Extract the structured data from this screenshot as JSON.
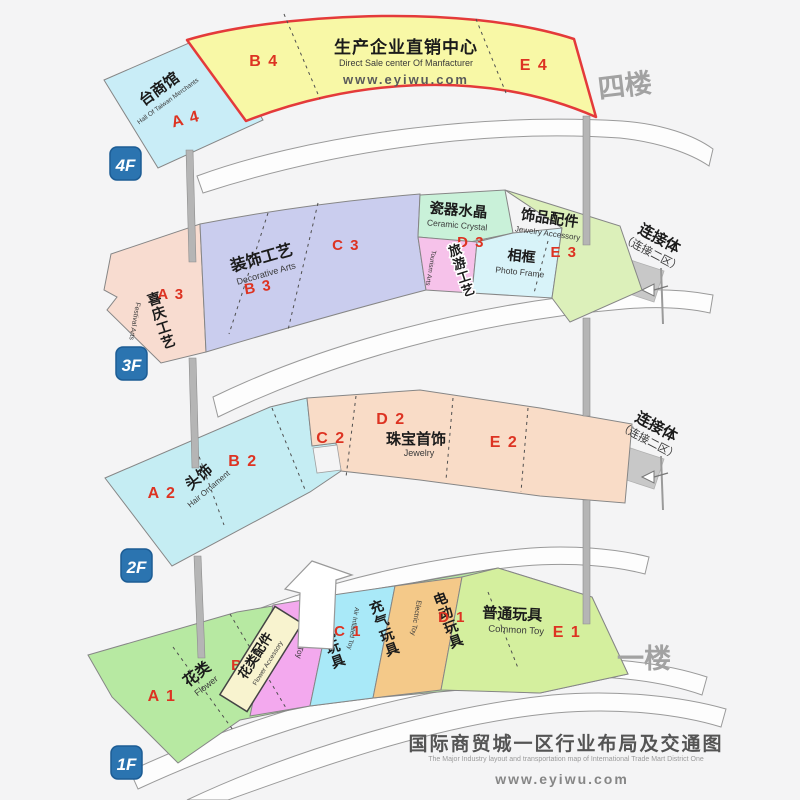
{
  "floor4": {
    "badge": "4F",
    "side_label": "四楼",
    "taiwan_hall": {
      "name": "台商馆",
      "name_en": "Hall Of Taiwan Merchants",
      "code": "A 4"
    },
    "b_code": "B 4",
    "direct_sale": {
      "name": "生产企业直销中心",
      "name_en": "Direct Sale center Of Manfacturer",
      "website": "www.eyiwu.com"
    },
    "e_code": "E 4"
  },
  "floor3": {
    "badge": "3F",
    "festival": {
      "name": "喜庆工艺",
      "name_en": "Festival Arts",
      "code": "A 3"
    },
    "decorative": {
      "name": "装饰工艺",
      "name_en": "Decorative Arts",
      "code_b": "B 3",
      "code_c": "C 3"
    },
    "ceramic": {
      "name": "瓷器水晶",
      "name_en": "Ceramic Crystal",
      "code": "D 3"
    },
    "tourism": {
      "name": "旅游工艺",
      "name_en": "Tourism Arts"
    },
    "photo_frame": {
      "name": "相框",
      "name_en": "Photo Frame"
    },
    "jewelry_accessory": {
      "name": "饰品配件",
      "name_en": "Jewelry Accessory",
      "code": "E 3"
    },
    "connector": {
      "line1": "连接体",
      "line2": "（连接二区）"
    }
  },
  "floor2": {
    "badge": "2F",
    "code_a": "A 2",
    "hair": {
      "name": "头饰",
      "name_en": "Hair Ornament"
    },
    "code_b": "B 2",
    "code_c": "C 2",
    "code_d": "D 2",
    "jewelry": {
      "name": "珠宝首饰",
      "name_en": "Jewelry"
    },
    "code_e": "E 2",
    "connector": {
      "line1": "连接体",
      "line2": "（连接二区）"
    }
  },
  "floor1": {
    "badge": "1F",
    "side_label": "一楼",
    "flower": {
      "name": "花类",
      "name_en": "Flower",
      "code": "A 1"
    },
    "flower_accessory": {
      "name": "花类配件",
      "name_en": "Flower Accessory",
      "code": "B 1"
    },
    "plush": {
      "name": "毛绒玩具",
      "name_en": "Plush Toy",
      "code": "C 1"
    },
    "inflatable": {
      "name": "充气玩具",
      "name_en": "Air Inflated Toy"
    },
    "electric": {
      "name": "电动玩具",
      "name_en": "Electric Toy",
      "code": "D 1"
    },
    "common": {
      "name": "普通玩具",
      "name_en": "Common Toy",
      "code": "E 1"
    }
  },
  "footer": {
    "title": "国际商贸城一区行业布局及交通图",
    "subtitle": "The Major Industry layout and transportation map of International Trade Mart District One",
    "website": "www.eyiwu.com"
  }
}
